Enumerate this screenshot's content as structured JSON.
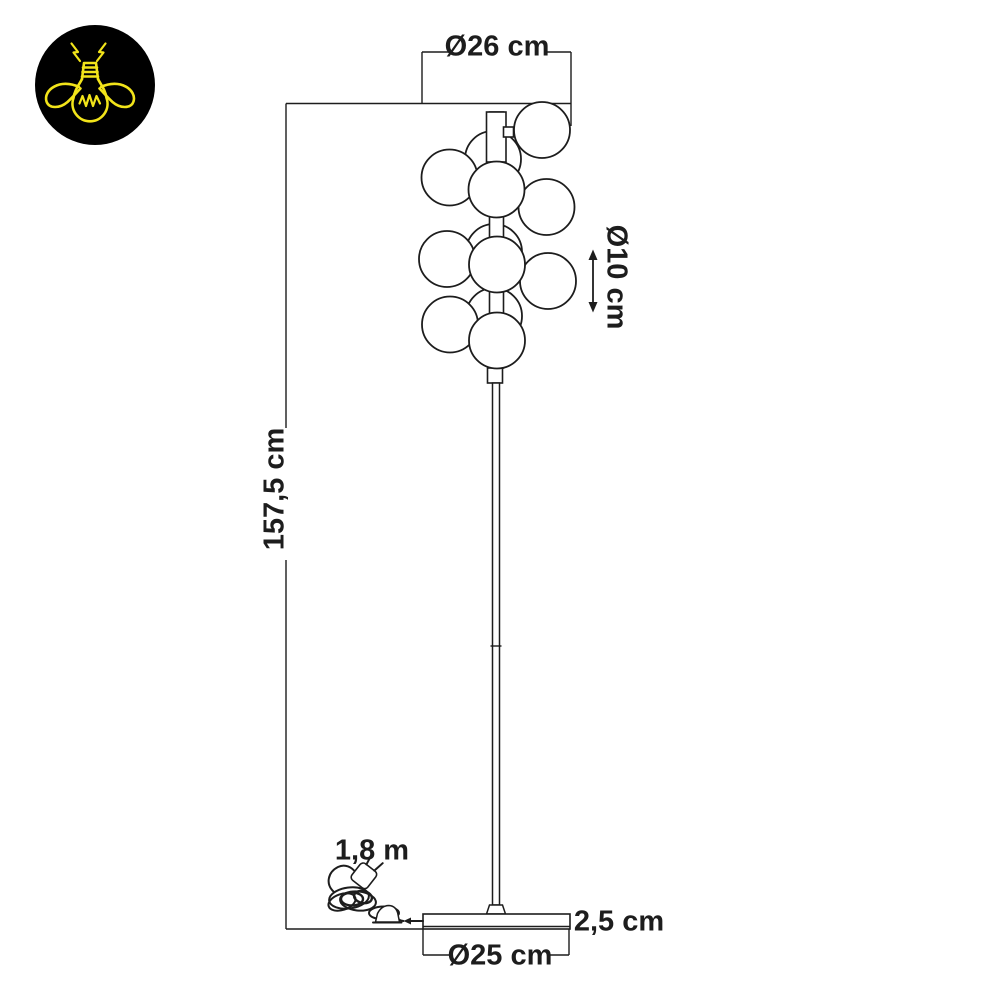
{
  "diagram": {
    "labels": {
      "head_diameter": "Ø26 cm",
      "bulb_diameter": "Ø10 cm",
      "total_height": "157,5 cm",
      "cable_length": "1,8 m",
      "base_height": "2,5 cm",
      "base_diameter": "Ø25 cm"
    },
    "colors": {
      "line-color": "#1d1d1d",
      "background": "#ffffff",
      "logo-background": "#000000",
      "logo-accent": "#f2e41a"
    }
  }
}
